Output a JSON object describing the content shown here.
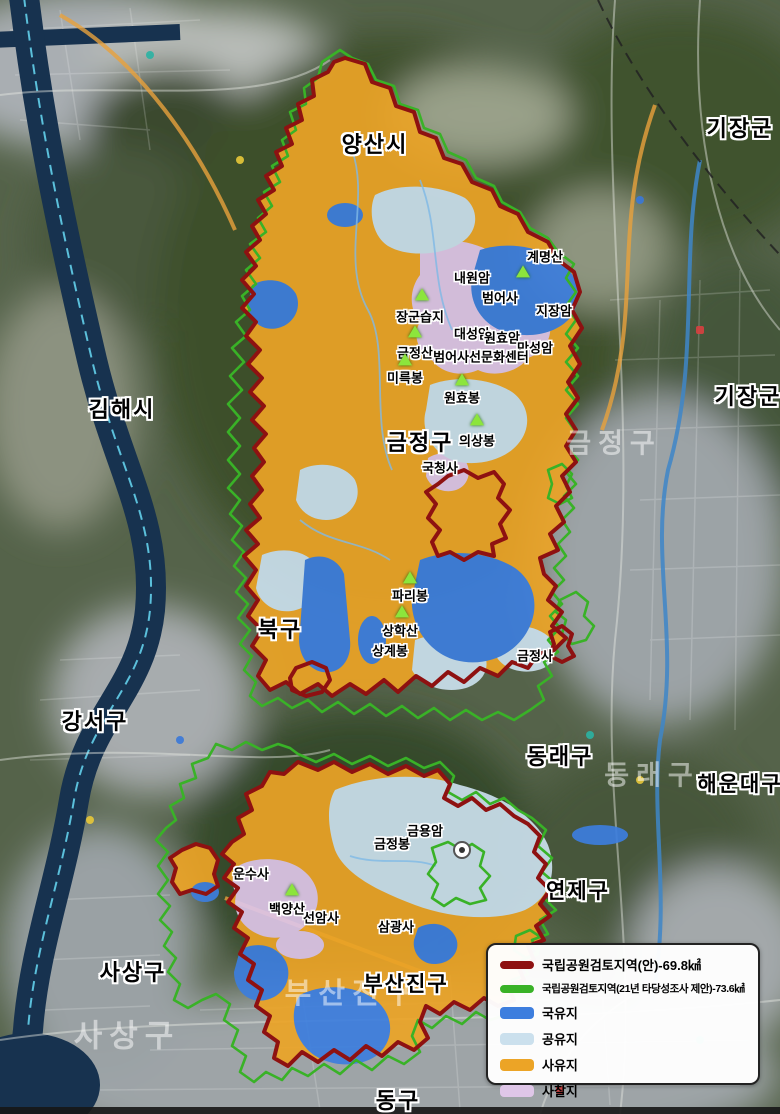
{
  "colors": {
    "private_land": "#ECA426",
    "national_land": "#3D7EDE",
    "public_land": "#CBE0ED",
    "temple_land": "#DFC6E8",
    "boundary_plan": "#8E1111",
    "boundary_proposal": "#39B227"
  },
  "legend": {
    "items": [
      {
        "swatch": "outline",
        "color": "boundary_plan",
        "label": "국립공원검토지역(안)-69.8㎢"
      },
      {
        "swatch": "outline",
        "color": "boundary_proposal",
        "label": "국립공원검토지역(21년 타당성조사 제안)-73.6㎢"
      },
      {
        "swatch": "fill",
        "color": "national_land",
        "label": "국유지"
      },
      {
        "swatch": "fill",
        "color": "public_land",
        "label": "공유지"
      },
      {
        "swatch": "fill",
        "color": "private_land",
        "label": "사유지"
      },
      {
        "swatch": "fill",
        "color": "temple_land",
        "label": "사찰지"
      }
    ]
  },
  "districts": [
    {
      "label": "양산시",
      "x": 375,
      "y": 143,
      "size": 22
    },
    {
      "label": "기장군",
      "x": 740,
      "y": 127,
      "size": 22
    },
    {
      "label": "김해시",
      "x": 122,
      "y": 408,
      "size": 22
    },
    {
      "label": "기장군",
      "x": 748,
      "y": 395,
      "size": 22
    },
    {
      "label": "금정구",
      "x": 420,
      "y": 441,
      "size": 22
    },
    {
      "label": "북구",
      "x": 280,
      "y": 628,
      "size": 22
    },
    {
      "label": "강서구",
      "x": 95,
      "y": 720,
      "size": 22
    },
    {
      "label": "동래구",
      "x": 560,
      "y": 755,
      "size": 22
    },
    {
      "label": "해운대구",
      "x": 740,
      "y": 783,
      "size": 21
    },
    {
      "label": "연제구",
      "x": 578,
      "y": 890,
      "size": 21
    },
    {
      "label": "사상구",
      "x": 133,
      "y": 971,
      "size": 22
    },
    {
      "label": "부산진구",
      "x": 406,
      "y": 983,
      "size": 21
    },
    {
      "label": "동구",
      "x": 398,
      "y": 1099,
      "size": 22
    }
  ],
  "watermarks": [
    {
      "label": "금정구",
      "x": 614,
      "y": 441,
      "size": 27
    },
    {
      "label": "동래구",
      "x": 652,
      "y": 773,
      "size": 27
    },
    {
      "label": "부산진구",
      "x": 352,
      "y": 991,
      "size": 29
    },
    {
      "label": "사상구",
      "x": 127,
      "y": 1033,
      "size": 31
    }
  ],
  "places": [
    {
      "label": "계명산",
      "x": 545,
      "y": 256
    },
    {
      "label": "내원암",
      "x": 472,
      "y": 277
    },
    {
      "label": "범어사",
      "x": 500,
      "y": 297
    },
    {
      "label": "지장암",
      "x": 554,
      "y": 310
    },
    {
      "label": "장군습지",
      "x": 420,
      "y": 316
    },
    {
      "label": "대성암",
      "x": 472,
      "y": 333
    },
    {
      "label": "원효암",
      "x": 502,
      "y": 337
    },
    {
      "label": "만성암",
      "x": 535,
      "y": 347
    },
    {
      "label": "금정산",
      "x": 415,
      "y": 352
    },
    {
      "label": "범어사선문화센터",
      "x": 481,
      "y": 356
    },
    {
      "label": "미륵봉",
      "x": 405,
      "y": 377
    },
    {
      "label": "원효봉",
      "x": 462,
      "y": 397
    },
    {
      "label": "의상봉",
      "x": 477,
      "y": 440
    },
    {
      "label": "국청사",
      "x": 440,
      "y": 467
    },
    {
      "label": "파리봉",
      "x": 410,
      "y": 595
    },
    {
      "label": "상학산",
      "x": 400,
      "y": 630
    },
    {
      "label": "상계봉",
      "x": 390,
      "y": 650
    },
    {
      "label": "금정사",
      "x": 535,
      "y": 655
    },
    {
      "label": "금용암",
      "x": 425,
      "y": 830
    },
    {
      "label": "금정봉",
      "x": 392,
      "y": 843
    },
    {
      "label": "운수사",
      "x": 251,
      "y": 873
    },
    {
      "label": "백양산",
      "x": 287,
      "y": 908
    },
    {
      "label": "선암사",
      "x": 321,
      "y": 917
    },
    {
      "label": "삼광사",
      "x": 396,
      "y": 926
    }
  ],
  "markers": [
    {
      "x": 523,
      "y": 272
    },
    {
      "x": 422,
      "y": 295
    },
    {
      "x": 415,
      "y": 332
    },
    {
      "x": 405,
      "y": 360
    },
    {
      "x": 462,
      "y": 380
    },
    {
      "x": 477,
      "y": 420
    },
    {
      "x": 410,
      "y": 578
    },
    {
      "x": 402,
      "y": 612
    },
    {
      "x": 292,
      "y": 890
    }
  ]
}
